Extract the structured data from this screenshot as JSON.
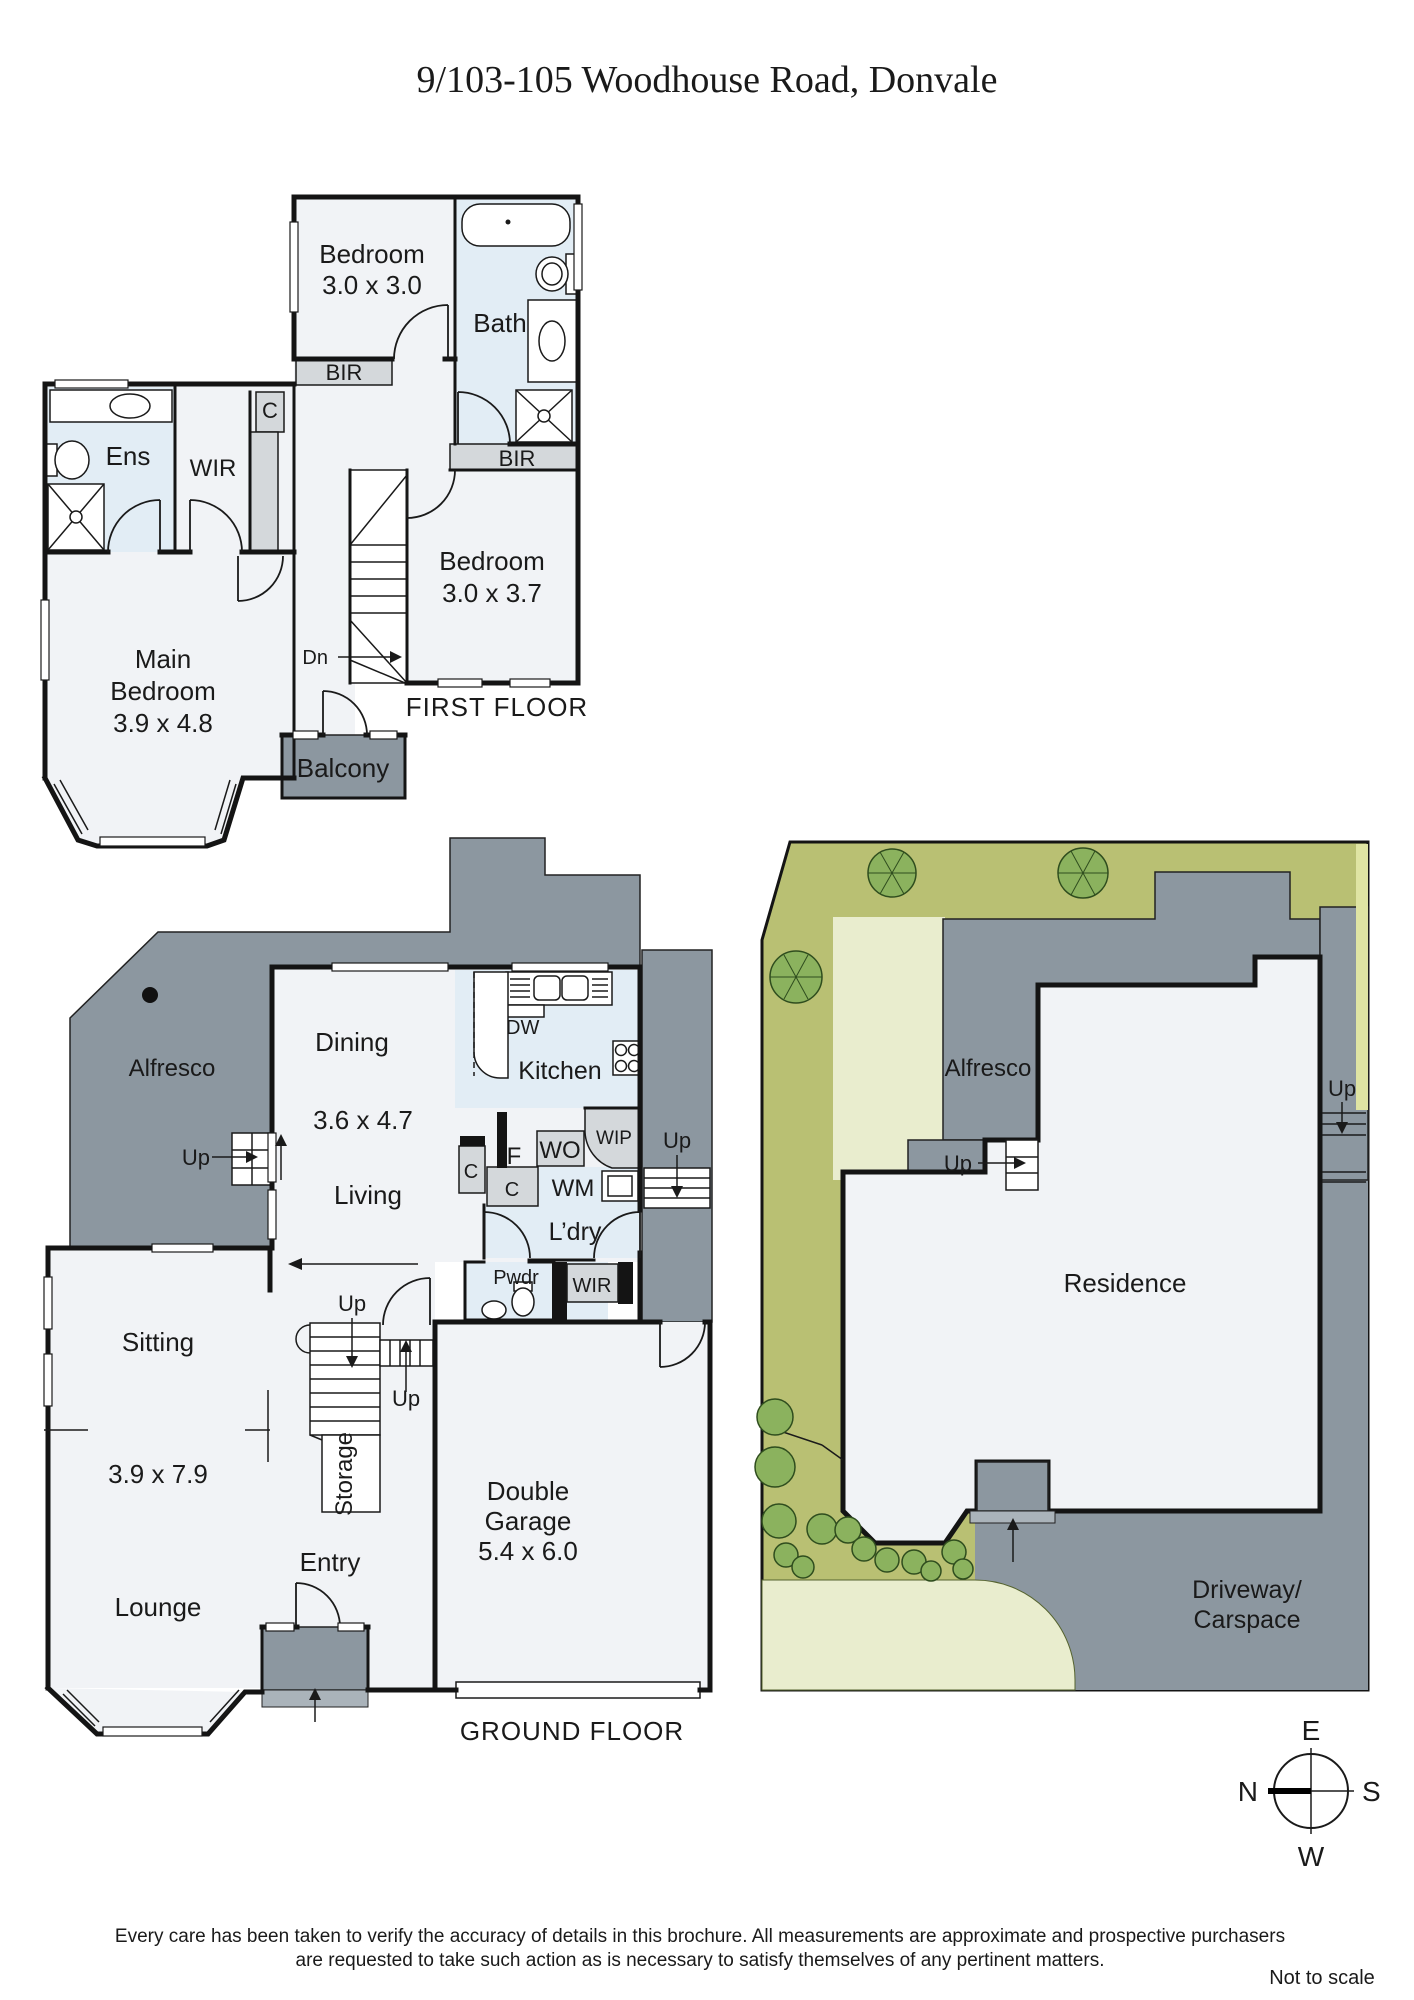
{
  "title": "9/103-105 Woodhouse Road, Donvale",
  "labels": {
    "up": "Up",
    "bir": "BIR",
    "c": "C",
    "wir": "WIR",
    "alfresco": "Alfresco",
    "dn": "Dn"
  },
  "first_floor": {
    "caption": "FIRST FLOOR",
    "bedroom2": {
      "name": "Bedroom",
      "dims": "3.0 x 3.0"
    },
    "bath": "Bath",
    "ens": "Ens",
    "bedroom3": {
      "name": "Bedroom",
      "dims": "3.0 x 3.7"
    },
    "main_bedroom": {
      "line1": "Main",
      "line2": "Bedroom",
      "dims": "3.9 x 4.8"
    },
    "balcony": "Balcony"
  },
  "ground_floor": {
    "caption": "GROUND FLOOR",
    "dining": {
      "name": "Dining",
      "dims": "3.6 x 4.7"
    },
    "living": "Living",
    "kitchen": "Kitchen",
    "dw": "DW",
    "wip": "WIP",
    "f": "F",
    "wo": "WO",
    "wm": "WM",
    "ldry": "L’dry",
    "pwdr": "Pwdr",
    "sitting": {
      "name": "Sitting",
      "dims": "3.9 x 7.9"
    },
    "lounge": "Lounge",
    "storage": "Storage",
    "entry": "Entry",
    "garage": {
      "line1": "Double",
      "line2": "Garage",
      "dims": "5.4 x 6.0"
    }
  },
  "site_plan": {
    "residence": "Residence",
    "driveway_line1": "Driveway/",
    "driveway_line2": "Carspace"
  },
  "compass": {
    "n": "N",
    "e": "E",
    "s": "S",
    "w": "W"
  },
  "footer": {
    "line1": "Every care has been taken to verify the accuracy of details in this brochure. All measurements are approximate and prospective purchasers",
    "line2": "are requested to take such action as is necessary to satisfy themselves of any pertinent matters.",
    "scale": "Not to scale"
  }
}
